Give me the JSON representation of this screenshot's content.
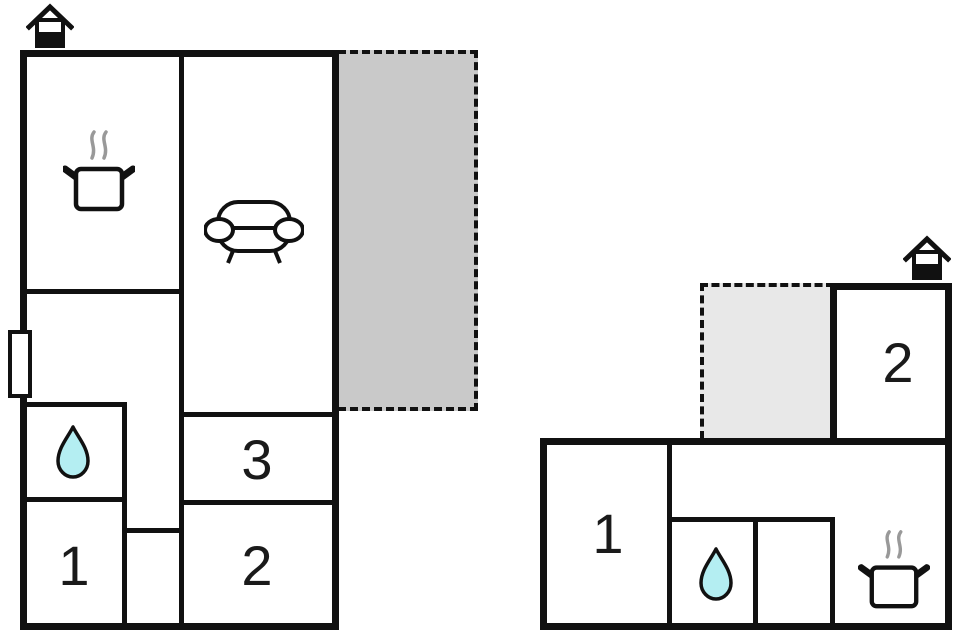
{
  "colors": {
    "wall": "#111111",
    "terrace_dark": "#c9c9c9",
    "terrace_light": "#e8e8e8",
    "water": "#b4eef2",
    "steam": "#999999",
    "background": "#ffffff"
  },
  "left_unit": {
    "room_labels": {
      "bedroom_1": "1",
      "bedroom_3": "3",
      "bedroom_2": "2"
    },
    "icons": {
      "kitchen": "cooking-pot-icon",
      "living_room": "sofa-icon",
      "bathroom": "water-drop-icon",
      "chimney": "house-chimney-icon",
      "window": "window-marker"
    }
  },
  "right_unit": {
    "room_labels": {
      "bedroom_1": "1",
      "bedroom_2": "2"
    },
    "icons": {
      "kitchen": "cooking-pot-icon",
      "bathroom": "water-drop-icon",
      "chimney": "house-chimney-icon"
    }
  }
}
